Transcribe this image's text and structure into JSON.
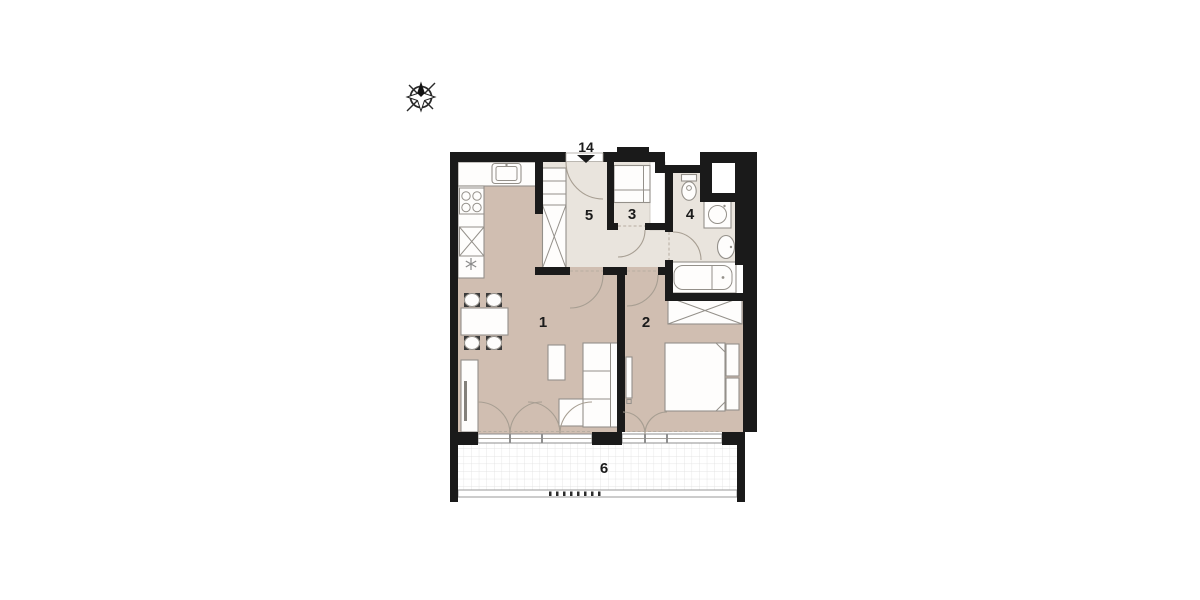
{
  "plan": {
    "entrance": {
      "label": "14",
      "marker": "down-triangle"
    },
    "rooms": [
      {
        "label": "1"
      },
      {
        "label": "2"
      },
      {
        "label": "3"
      },
      {
        "label": "4"
      },
      {
        "label": "5"
      },
      {
        "label": "6"
      }
    ]
  },
  "icons": {
    "compass": "compass-rose",
    "kitchen": [
      "sink",
      "stove-4-burners",
      "tall-cabinet-x",
      "dishwasher-asterisk"
    ],
    "bathroom": [
      "toilet",
      "washing-machine",
      "washbasin",
      "bathtub"
    ],
    "furniture": [
      "dining-table",
      "chairs",
      "coffee-table",
      "sofa",
      "sideboard-tv",
      "wardrobe-x",
      "double-bed",
      "mirror"
    ]
  },
  "colors": {
    "wall": "#1a1a1a",
    "floor_main": "#d0beb1",
    "floor_service": "#e9e4dd",
    "balcony_grid": "#dddddd",
    "furniture_stroke": "#94908a",
    "door_arc": "#a79e92",
    "label_text": "#1b1b1b"
  }
}
